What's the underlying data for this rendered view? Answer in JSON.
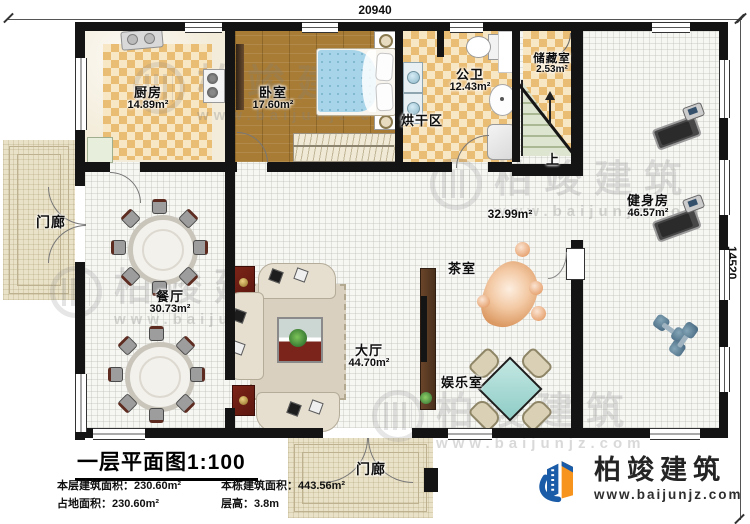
{
  "dimensions": {
    "width_top": "20940",
    "height_right": "14520"
  },
  "rooms": {
    "kitchen": {
      "name": "厨房",
      "area": "14.89m²"
    },
    "bedroom": {
      "name": "卧室",
      "area": "17.60m²"
    },
    "bathroom": {
      "name": "公卫",
      "area": "12.43m²"
    },
    "storage": {
      "name": "储藏室",
      "area": "2.53m²"
    },
    "drying": {
      "name": "烘干区"
    },
    "gym": {
      "name": "健身房",
      "area": "46.57m²"
    },
    "corridor": {
      "area": "32.99m²"
    },
    "tea_room": {
      "name": "茶室"
    },
    "game_room": {
      "name": "娱乐室"
    },
    "dining": {
      "name": "餐厅",
      "area": "30.73m²"
    },
    "hall": {
      "name": "大厅",
      "area": "44.70m²"
    },
    "porch_left": {
      "name": "门廊"
    },
    "porch_bottom": {
      "name": "门廊"
    },
    "stairs": {
      "label": "上"
    }
  },
  "title_block": {
    "title": "一层平面图1:100",
    "stats": {
      "row1_left": "本层建筑面积：230.60m²",
      "row1_right": "本栋建筑面积：443.56m²",
      "row2_left": "占地面积：230.60m²",
      "row2_right": "层高：3.8m"
    }
  },
  "branding": {
    "company": "柏竣建筑",
    "website": "www.baijunjz.com"
  },
  "watermark": {
    "text": "柏竣建筑",
    "website": "www.baijunjz.com"
  },
  "colors": {
    "wall": "#141414",
    "checker_tile": "#eabd75",
    "wood_floor": "#a87c35",
    "logo_blue": "#1b5ca8",
    "logo_orange": "#f7941e",
    "accent_red": "#6b1d14",
    "mahjong_teal": "#a6d8d4",
    "stair_green": "#cfd8c2"
  }
}
